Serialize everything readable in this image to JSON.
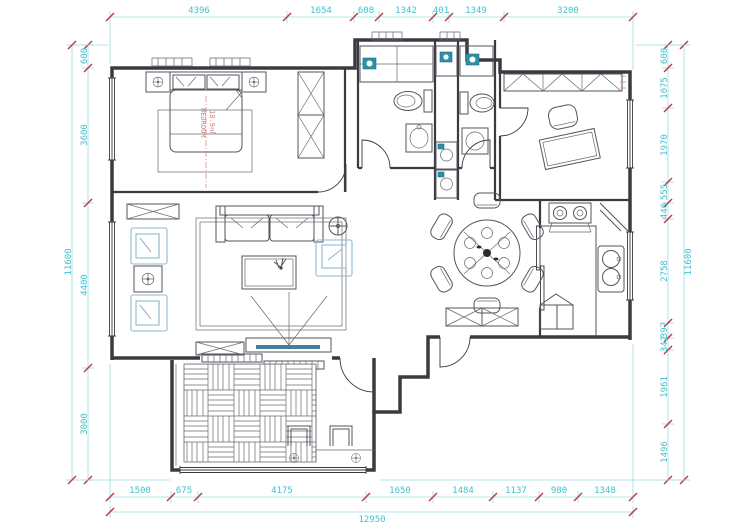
{
  "drawing": {
    "type": "apartment-floor-plan"
  },
  "colors": {
    "dim_line": "#9adde3",
    "dim_text": "#3fc1cf",
    "tick_red": "#c0394b",
    "wall": "#3a3a41",
    "appliance_teal": "#2e8fa8",
    "room_label_red": "#cf8080",
    "armchair_blue": "#8fb8cc"
  },
  "dimensions": {
    "top": [
      "4396",
      "1654",
      "608",
      "1342",
      "401",
      "1349",
      "3200"
    ],
    "bottom": [
      "1500",
      "675",
      "4175",
      "1650",
      "1484",
      "1137",
      "980",
      "1348"
    ],
    "bottom_total": "12950",
    "left": [
      "600",
      "3600",
      "4400",
      "3000"
    ],
    "left_total": "11600",
    "right": [
      "600",
      "1075",
      "1970",
      "555",
      "446",
      "2758",
      "397",
      "342",
      "1961",
      "1496"
    ],
    "right_total": "11600"
  },
  "labels": {
    "bedroom": "BEDROOM",
    "bedroom_area": "18.9㎡"
  }
}
